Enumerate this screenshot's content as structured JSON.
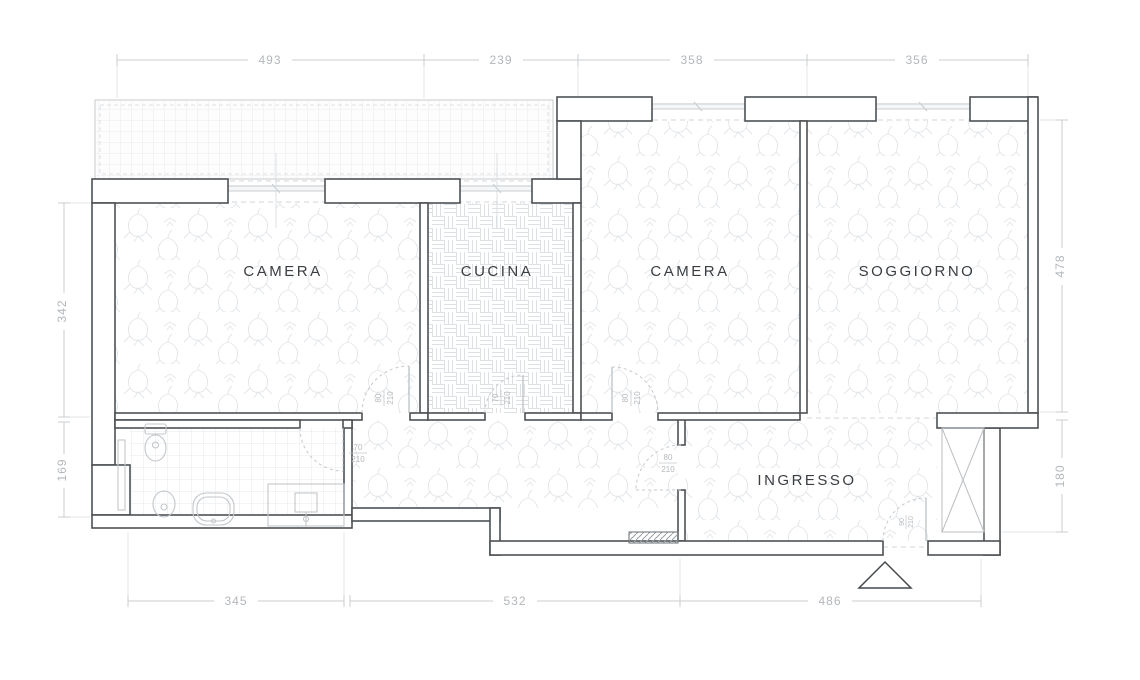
{
  "drawing": {
    "type": "apartment floor plan",
    "unit": "cm"
  },
  "rooms": {
    "camera1": {
      "label": "CAMERA"
    },
    "cucina": {
      "label": "CUCINA"
    },
    "camera2": {
      "label": "CAMERA"
    },
    "soggiorno": {
      "label": "SOGGIORNO"
    },
    "ingresso": {
      "label": "INGRESSO"
    }
  },
  "dimensions": {
    "top": [
      "493",
      "239",
      "358",
      "356"
    ],
    "left": [
      "342",
      "169"
    ],
    "right": [
      "478",
      "180"
    ],
    "bottom": [
      "345",
      "532",
      "486"
    ]
  },
  "doors": {
    "camera1": {
      "width": "80",
      "height": "210"
    },
    "cucina": {
      "width": "70",
      "height": "210"
    },
    "camera2": {
      "width": "80",
      "height": "210"
    },
    "bathroom": {
      "width": "70",
      "height": "210"
    },
    "hall": {
      "width": "80",
      "height": "210"
    },
    "entry": {
      "width": "90",
      "height": "210"
    }
  },
  "colors": {
    "wall_outline": "#4d5154",
    "floor_pattern": "#e2e5e8",
    "dimension_gray": "#b3b7bb",
    "label_dark": "#3a3e42",
    "background": "#ffffff"
  }
}
